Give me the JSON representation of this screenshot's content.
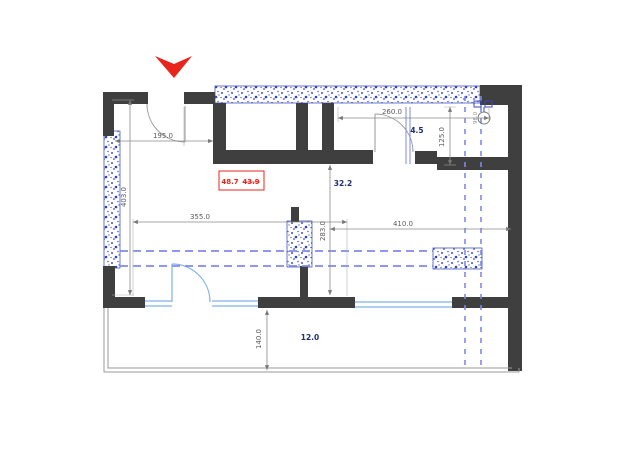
{
  "dims": {
    "w195": "195.0",
    "h403": "403.0",
    "w355": "355.0",
    "h283": "283.0",
    "w410": "410.0",
    "w260": "260.0",
    "h125": "125.0",
    "h140": "140.0",
    "riser": "98.0"
  },
  "rooms": {
    "bathroom": "4.5",
    "living": "32.2",
    "balcony": "12.0"
  },
  "area_box": {
    "total": "48.7",
    "previous": "43.9"
  },
  "icons": {
    "entrance_arrow": "red-entrance-arrow",
    "plumbing_riser": "plumbing-riser"
  },
  "colors": {
    "wall": "#3f3f3f",
    "hatch_blue": "#3847c0",
    "dashed_blue": "#8089e6",
    "window_blue": "#7fb2e6",
    "dim_gray": "#5a5a5a",
    "red": "#e8251d",
    "label_navy": "#1e2f6e"
  }
}
